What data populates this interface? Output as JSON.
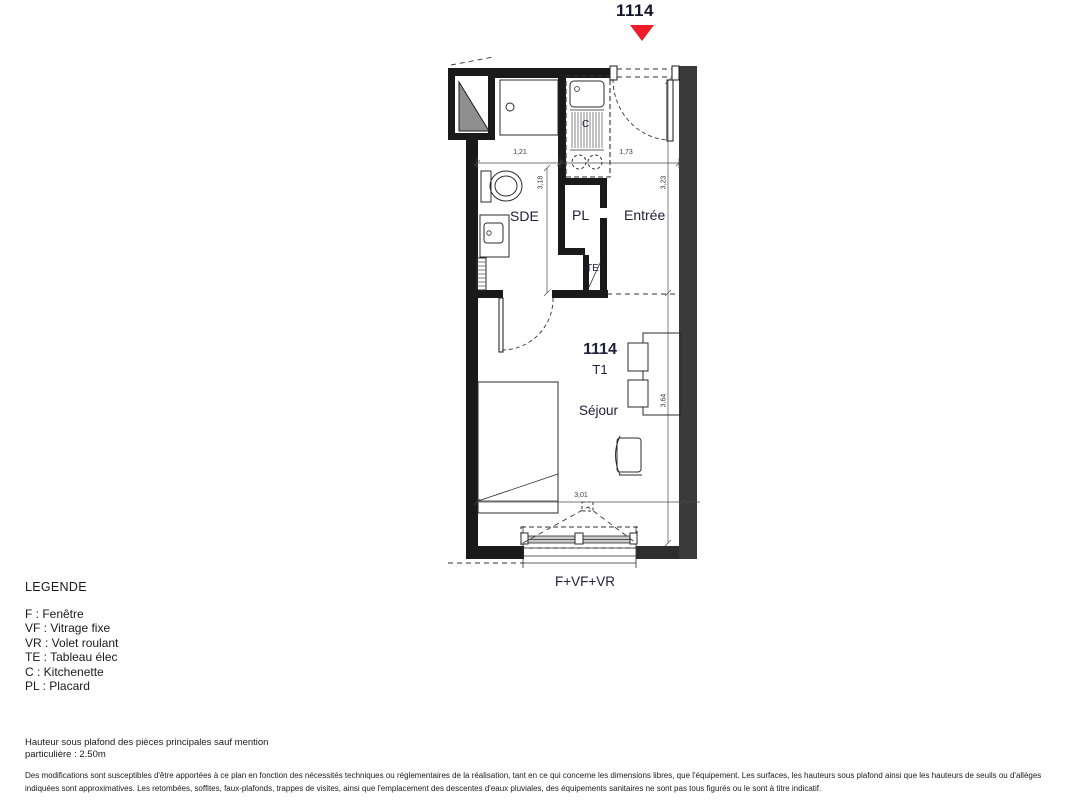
{
  "marker": {
    "unit": "1114"
  },
  "plan": {
    "unit_number": "1114",
    "unit_type": "T1",
    "rooms": {
      "sde": "SDE",
      "placard": "PL",
      "entree": "Entrée",
      "tableau_elec": "TE",
      "kitchenette": "C",
      "sejour": "Séjour"
    },
    "window_label": "F+VF+VR",
    "dims": {
      "top_left": "1,21",
      "top_right": "1,73",
      "left_vert": "3,18",
      "right_upper_vert": "3,23",
      "right_lower_vert": "3,64",
      "bottom_horiz": "3,01"
    }
  },
  "legend": {
    "title": "LEGENDE",
    "items": [
      "F : Fenêtre",
      "VF : Vitrage fixe",
      "VR : Volet roulant",
      "TE : Tableau élec",
      "C : Kitchenette",
      "PL : Placard"
    ]
  },
  "notes": {
    "ceiling_height": "Hauteur sous plafond des pièces principales sauf mention\nparticulière : 2.50m",
    "disclaimer": "Des modifications sont susceptibles d'être apportées à ce plan en fonction des nécessités techniques ou réglementaires de la réalisation, tant en ce qui concerne les dimensions libres, que l'équipement. Les surfaces, les hauteurs sous plafond ainsi que les hauteurs de seuils ou d'allèges indiquées sont approximatives. Les retombées, soffites, faux-plafonds, trappes de visites, ainsi que l'emplacement des descentes d'eaux pluviales, des équipements sanitaires ne sont pas tous figurés ou le sont à titre indicatif."
  },
  "colors": {
    "marker_red": "#ed1c29",
    "wall_dark": "#1a1a1a",
    "wall_party": "#3a3a3a",
    "shaft_gray": "#8f8f8f"
  }
}
